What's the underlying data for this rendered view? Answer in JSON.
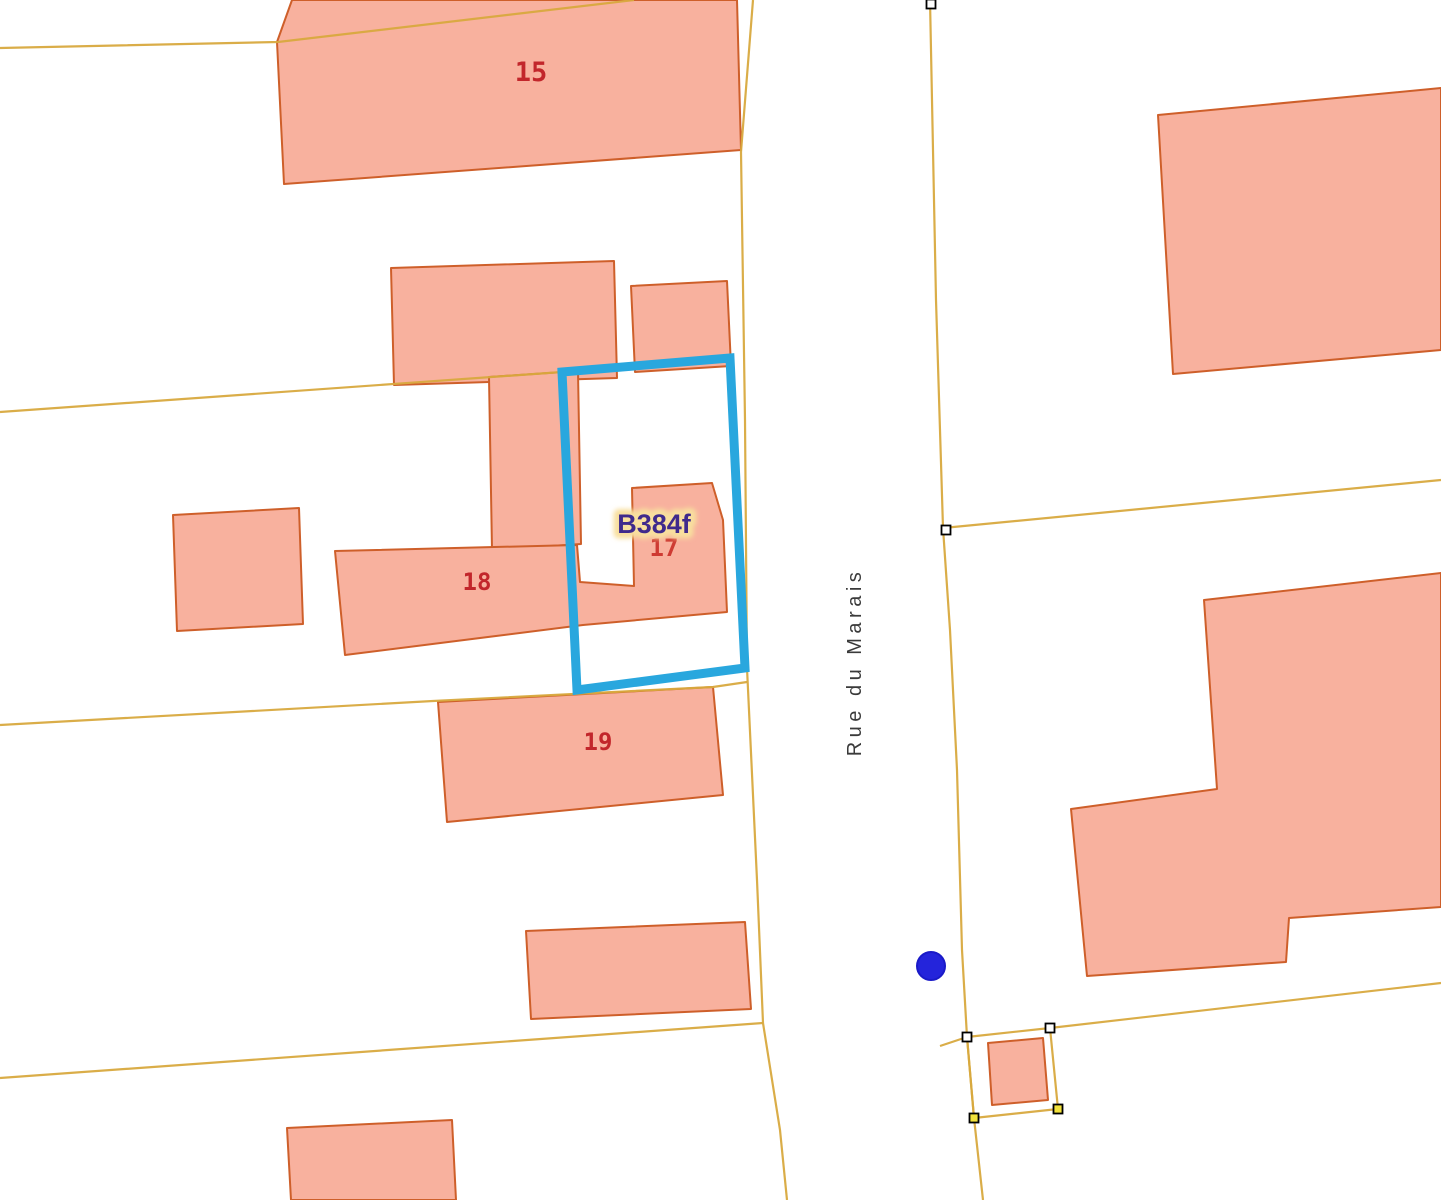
{
  "map": {
    "background": "#FFFFFF",
    "palette": {
      "building_fill": "#F8B19E",
      "building_stroke": "#CE5F2A",
      "parcel_line": "#D8A93E",
      "selection_blue": "#29A7DE",
      "marker_blue": "#2424DB",
      "vertex_white": "#FFFFFF",
      "vertex_yellow": "#F2E23B",
      "label_red": "#C2262B",
      "label_red_bright": "#CE3B33",
      "label_purple": "#3F2A8C",
      "label_halo": "#F8DF9E",
      "street_text": "#3A3A3A"
    },
    "buildings": [
      {
        "id": "building-15",
        "points": [
          [
            292,
            0
          ],
          [
            737,
            0
          ],
          [
            741,
            150
          ],
          [
            284,
            184
          ],
          [
            277,
            42
          ]
        ]
      },
      {
        "id": "building-top-small",
        "points": [
          [
            631,
            286
          ],
          [
            727,
            281
          ],
          [
            731,
            366
          ],
          [
            635,
            372
          ]
        ]
      },
      {
        "id": "building-top-rect",
        "points": [
          [
            391,
            268
          ],
          [
            614,
            261
          ],
          [
            617,
            378
          ],
          [
            394,
            385
          ]
        ]
      },
      {
        "id": "building-wing",
        "points": [
          [
            489,
            377
          ],
          [
            578,
            371
          ],
          [
            581,
            544
          ],
          [
            492,
            550
          ]
        ]
      },
      {
        "id": "building-17-18",
        "points": [
          [
            335,
            551
          ],
          [
            577,
            545
          ],
          [
            580,
            582
          ],
          [
            634,
            586
          ],
          [
            632,
            488
          ],
          [
            712,
            483
          ],
          [
            723,
            520
          ],
          [
            727,
            612
          ],
          [
            583,
            625
          ],
          [
            345,
            655
          ]
        ]
      },
      {
        "id": "building-left-small",
        "points": [
          [
            173,
            515
          ],
          [
            299,
            508
          ],
          [
            303,
            624
          ],
          [
            177,
            631
          ]
        ]
      },
      {
        "id": "building-19",
        "points": [
          [
            438,
            702
          ],
          [
            713,
            687
          ],
          [
            723,
            795
          ],
          [
            447,
            822
          ]
        ]
      },
      {
        "id": "building-bottom-mid",
        "points": [
          [
            526,
            931
          ],
          [
            745,
            922
          ],
          [
            751,
            1009
          ],
          [
            531,
            1019
          ]
        ]
      },
      {
        "id": "building-bottom-left",
        "points": [
          [
            287,
            1128
          ],
          [
            452,
            1120
          ],
          [
            456,
            1200
          ],
          [
            291,
            1200
          ]
        ]
      },
      {
        "id": "building-top-right",
        "points": [
          [
            1158,
            115
          ],
          [
            1441,
            88
          ],
          [
            1441,
            350
          ],
          [
            1173,
            374
          ]
        ]
      },
      {
        "id": "building-mid-right",
        "points": [
          [
            1204,
            600
          ],
          [
            1441,
            573
          ],
          [
            1441,
            907
          ],
          [
            1289,
            918
          ],
          [
            1286,
            962
          ],
          [
            1087,
            976
          ],
          [
            1071,
            809
          ],
          [
            1217,
            789
          ]
        ]
      },
      {
        "id": "building-small-parcel",
        "points": [
          [
            988,
            1043
          ],
          [
            1043,
            1038
          ],
          [
            1048,
            1100
          ],
          [
            992,
            1105
          ]
        ]
      }
    ],
    "parcel_lines": [
      {
        "id": "boundary-top-left",
        "points": [
          [
            0,
            48
          ],
          [
            278,
            42
          ],
          [
            634,
            0
          ]
        ]
      },
      {
        "id": "boundary-left-2",
        "points": [
          [
            0,
            412
          ],
          [
            562,
            372
          ]
        ]
      },
      {
        "id": "boundary-left-3",
        "points": [
          [
            0,
            725
          ],
          [
            433,
            701
          ],
          [
            713,
            687
          ],
          [
            747,
            682
          ]
        ]
      },
      {
        "id": "boundary-left-4",
        "points": [
          [
            0,
            1078
          ],
          [
            763,
            1023
          ]
        ]
      },
      {
        "id": "road-left-edge",
        "points": [
          [
            753,
            0
          ],
          [
            741,
            152
          ],
          [
            745,
            420
          ],
          [
            747,
            668
          ],
          [
            757,
            880
          ],
          [
            763,
            1023
          ],
          [
            780,
            1130
          ],
          [
            787,
            1200
          ]
        ]
      },
      {
        "id": "road-right-edge",
        "points": [
          [
            930,
            0
          ],
          [
            936,
            300
          ],
          [
            943,
            528
          ],
          [
            950,
            630
          ],
          [
            957,
            770
          ],
          [
            962,
            950
          ],
          [
            967,
            1037
          ],
          [
            974,
            1118
          ],
          [
            983,
            1200
          ]
        ]
      },
      {
        "id": "boundary-branch-right",
        "points": [
          [
            943,
            528
          ],
          [
            1441,
            480
          ]
        ]
      },
      {
        "id": "boundary-bottom-right",
        "points": [
          [
            1050,
            1028
          ],
          [
            1441,
            983
          ]
        ]
      },
      {
        "id": "boundary-cross-stub",
        "points": [
          [
            940,
            1046
          ],
          [
            967,
            1037
          ]
        ]
      },
      {
        "id": "small-parcel-outline",
        "points": [
          [
            967,
            1037
          ],
          [
            1050,
            1028
          ],
          [
            1058,
            1109
          ],
          [
            974,
            1118
          ],
          [
            967,
            1037
          ]
        ]
      }
    ],
    "selection": {
      "id": "selected-parcel-B384f",
      "points": [
        [
          562,
          372
        ],
        [
          730,
          358
        ],
        [
          745,
          668
        ],
        [
          577,
          690
        ]
      ],
      "stroke_width": 9
    },
    "vertices": [
      {
        "x": 931,
        "y": 4,
        "fill": "white"
      },
      {
        "x": 946,
        "y": 530,
        "fill": "white"
      },
      {
        "x": 967,
        "y": 1037,
        "fill": "white"
      },
      {
        "x": 1050,
        "y": 1028,
        "fill": "white"
      },
      {
        "x": 974,
        "y": 1118,
        "fill": "yellow"
      },
      {
        "x": 1058,
        "y": 1109,
        "fill": "yellow"
      }
    ],
    "marker": {
      "x": 931,
      "y": 966,
      "r": 14
    },
    "labels": [
      {
        "id": "house-number-15",
        "text": "15",
        "x": 531,
        "y": 81,
        "size": 27,
        "color": "red",
        "family": "mono",
        "bold": true
      },
      {
        "id": "house-number-18",
        "text": "18",
        "x": 477,
        "y": 590,
        "size": 24,
        "color": "red",
        "family": "mono",
        "bold": true
      },
      {
        "id": "house-number-19",
        "text": "19",
        "x": 598,
        "y": 750,
        "size": 24,
        "color": "red",
        "family": "mono",
        "bold": true
      },
      {
        "id": "house-number-17",
        "text": "17",
        "x": 664,
        "y": 556,
        "size": 24,
        "color": "red2",
        "family": "mono",
        "bold": true
      },
      {
        "id": "parcel-id-label",
        "text": "B384f",
        "x": 654,
        "y": 533,
        "size": 27,
        "color": "purple",
        "family": "sans",
        "bold": true,
        "halo": true
      },
      {
        "id": "street-name",
        "text": "Rue du Marais",
        "x": 861,
        "y": 662,
        "size": 20,
        "color": "street",
        "family": "sans",
        "bold": false,
        "rotate": -90,
        "spacing": 4.5
      }
    ]
  }
}
